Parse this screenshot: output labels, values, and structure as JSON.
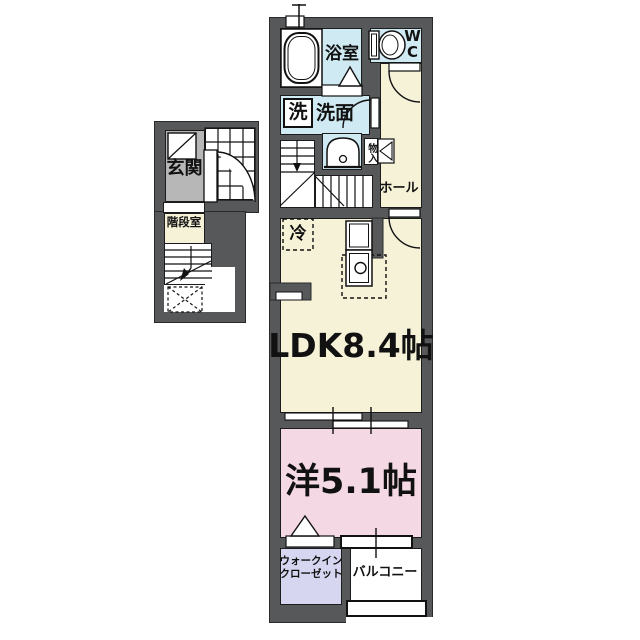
{
  "plan_title": "1LDK apartment floor plan (2F)",
  "colors": {
    "wall": "#57585a",
    "wet_area_floor": "#cfeaf2",
    "living_floor": "#f6f2d8",
    "bedroom_floor": "#f4d8e4",
    "closet_floor": "#d6d6f0",
    "entrance_floor": "#b7b7b7",
    "line": "#1c1c1c"
  },
  "rooms": {
    "bathroom": {
      "label": "浴室"
    },
    "toilet": {
      "label_line1": "W",
      "label_line2": "C"
    },
    "washer": {
      "label": "洗"
    },
    "washroom": {
      "label": "洗面"
    },
    "storage": {
      "label": "物入"
    },
    "hall": {
      "label": "ホール"
    },
    "entrance": {
      "label": "玄関"
    },
    "stairwell": {
      "label": "階段室"
    },
    "fridge": {
      "label": "冷"
    },
    "ldk": {
      "label": "LDK8.4帖"
    },
    "western_room": {
      "label": "洋5.1帖"
    },
    "walk_in_closet": {
      "label_line1": "ウォークイン",
      "label_line2": "クローゼット"
    },
    "balcony": {
      "label": "バルコニー"
    }
  }
}
